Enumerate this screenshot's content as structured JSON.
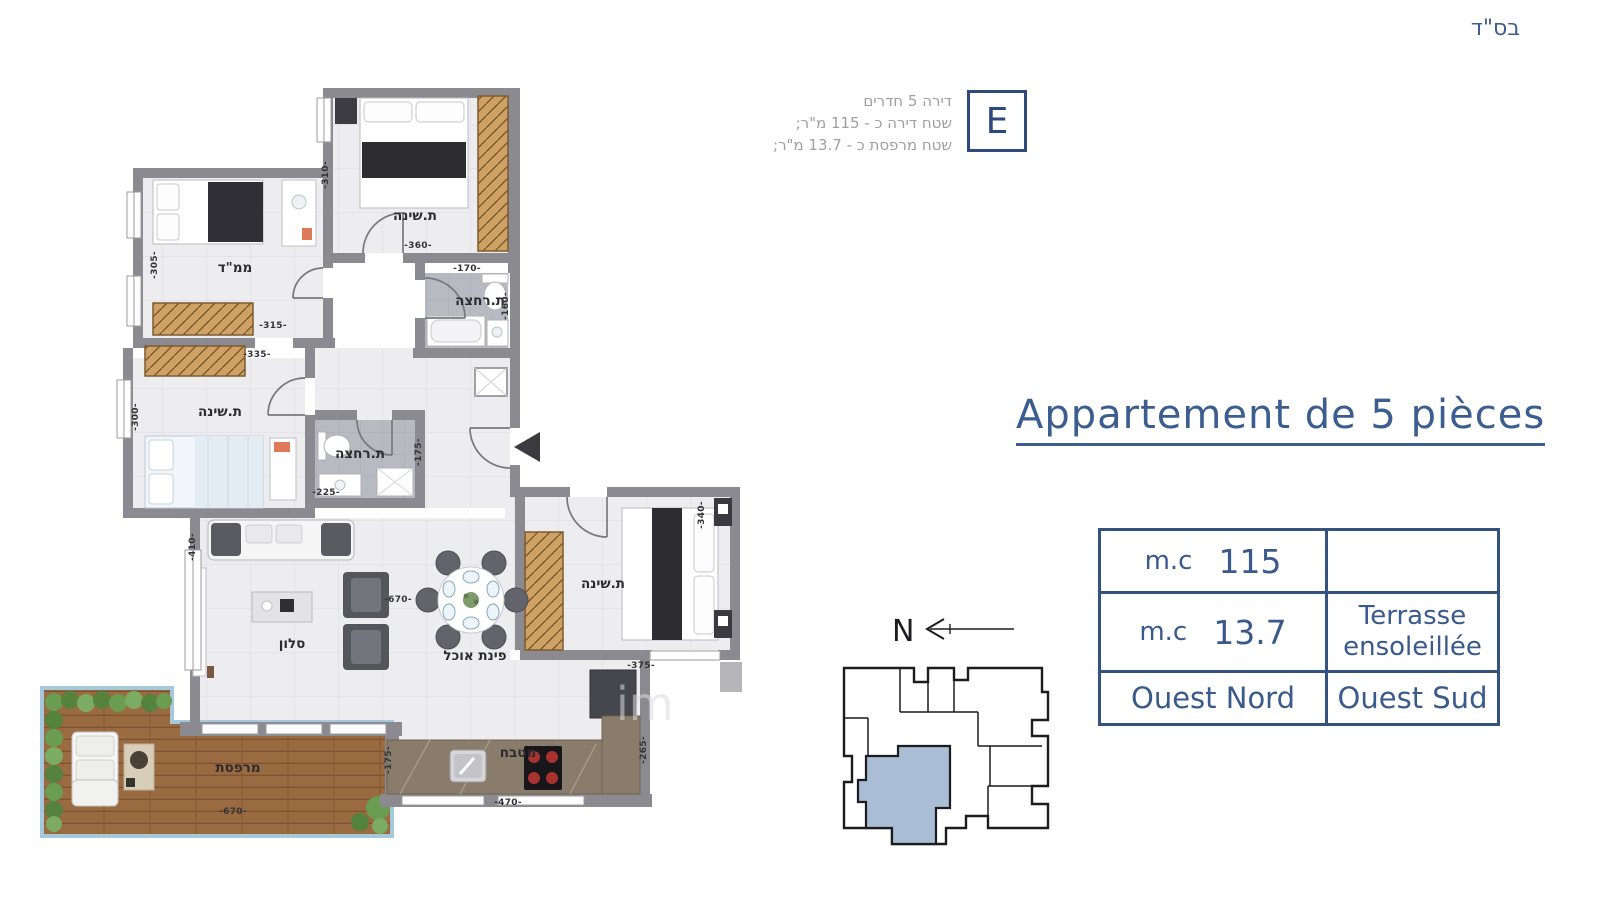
{
  "header": {
    "bsd": "בס\"ד"
  },
  "unit_info": {
    "lines": [
      "דירה 5 חדרים",
      "שטח דירה כ - 115 מ\"ר;",
      "שטח מרפסת כ - 13.7 מ\"ר;"
    ],
    "unit_letter": "E"
  },
  "title": {
    "text": "Appartement de 5 pièces"
  },
  "spec_table": {
    "row1": {
      "label": "m.c",
      "value": "115",
      "right": ""
    },
    "row2": {
      "label": "m.c",
      "value": "13.7",
      "right_line1": "Terrasse",
      "right_line2": "ensoleillée"
    },
    "row3": {
      "left": "Ouest Nord",
      "right": "Ouest Sud"
    }
  },
  "compass": {
    "north_label": "N"
  },
  "watermark": {
    "text": "im"
  },
  "plan": {
    "rooms": [
      "ת.שינה",
      "ממ\"ד",
      "ת.רחצה",
      "ת.שינה",
      "ת.רחצה",
      "סלון",
      "פינת אוכל",
      "ת.שינה",
      "מטבח",
      "מרפסת"
    ],
    "dims": [
      "-310-",
      "-360-",
      "-170-",
      "-160-",
      "-305-",
      "-315-",
      "-335-",
      "-300-",
      "-225-",
      "-175-",
      "-410-",
      "-670-",
      "-340-",
      "-375-",
      "-265-",
      "-470-",
      "-670-",
      "-175-"
    ]
  },
  "colors": {
    "accent_blue": "#3c5d90",
    "table_border": "#34527e",
    "wall_gray": "#8a8a90",
    "keyplan_unit_fill": "#a9bdd5",
    "deck_wood": "#9a6a41",
    "info_gray": "#9f9fa2"
  }
}
